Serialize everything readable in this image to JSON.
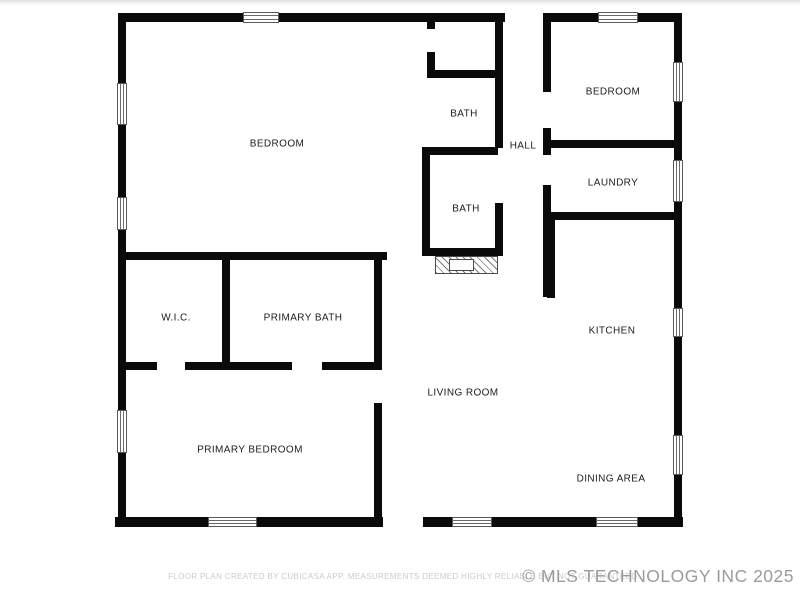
{
  "rooms": {
    "bedroom_left": "BEDROOM",
    "bath_upper": "BATH",
    "hall": "HALL",
    "bedroom_right": "BEDROOM",
    "laundry": "LAUNDRY",
    "bath_lower": "BATH",
    "wic": "W.I.C.",
    "primary_bath": "PRIMARY BATH",
    "kitchen": "KITCHEN",
    "living_room": "LIVING ROOM",
    "dining_area": "DINING AREA",
    "primary_bedroom": "PRIMARY BEDROOM"
  },
  "footer": {
    "disclaimer": "FLOOR PLAN CREATED BY CUBICASA APP. MEASUREMENTS DEEMED HIGHLY RELIABLE BUT NOT GUARANTEED.",
    "watermark": "© MLS TECHNOLOGY INC 2025"
  },
  "colors": {
    "wall": "#0a0a0a",
    "background": "#ffffff",
    "label_text": "#1c1c1c",
    "disclaimer_text": "#cbcbcb",
    "watermark_text": "#9b9b9b"
  }
}
